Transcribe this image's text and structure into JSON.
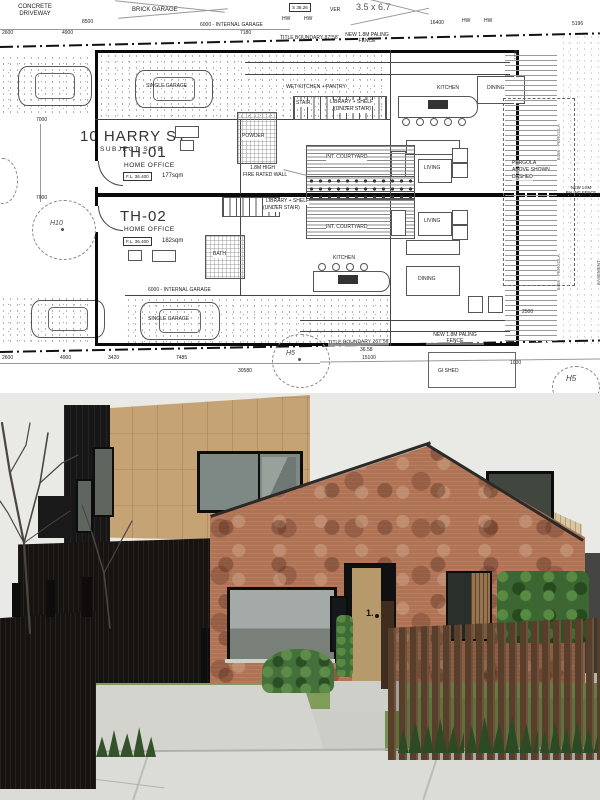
{
  "plan": {
    "site": {
      "title": "10 HARRY ST",
      "subtitle": "SUBJECT SITE",
      "tree_h10": "H10",
      "tree_h5": "H5",
      "gi_shed": "GI SHED",
      "concrete_driveway": "CONCRETE DRIVEWAY",
      "brick_garage": "BRICK GARAGE",
      "neighbor_garage_size": "3.5 x 6.7",
      "spot_level": "S 38.26",
      "veranda": "VER",
      "hw_marker": "HW"
    },
    "boundaries": {
      "top_label": "TITLE BOUNDARY  87°58'",
      "bottom_label": "TITLE BOUNDARY  267°58'",
      "bottom_length": "36.58",
      "fence_note": "NEW 1.8M PALING FENCE",
      "easement": "EASEMENT",
      "pergola_line1": "PERGOLA",
      "pergola_line2": "ABOVE SHOWN",
      "pergola_line3": "DASHED",
      "pergola_dim": "6455 - PERGOLA"
    },
    "units": {
      "th01": {
        "id": "TH-01",
        "use": "HOME OFFICE",
        "level": "F.L. 36.400",
        "area": "177sqm"
      },
      "th02": {
        "id": "TH-02",
        "use": "HOME OFFICE",
        "level": "F.L. 36.400",
        "area": "182sqm"
      }
    },
    "rooms": {
      "single_garage": "SINGLE GARAGE",
      "internal_garage": "6000 - INTERNAL GARAGE",
      "wet_kitchen": "WET KITCHEN + PANTRY",
      "stair": "STAIR",
      "library_line1": "LIBRARY + SHELF",
      "library_line2": "(UNDER STAIR)",
      "kitchen": "KITCHEN",
      "dining": "DINING",
      "living": "LIVING",
      "courtyard": "INT. COURTYARD",
      "powder": "POWDER",
      "bath": "BATH",
      "firewall_line1": "1.8M HIGH",
      "firewall_line2": "FIRE RATED WALL"
    },
    "dims": {
      "d8500": "8500",
      "d7180": "7180",
      "d16400": "16400",
      "d5196": "5196",
      "d2600": "2600",
      "d4900": "4900",
      "d3420": "3420",
      "d7485": "7485",
      "d30580": "30580",
      "d15100": "15100",
      "d1000": "1000",
      "d2500": "2500",
      "d7000": "7000",
      "d1730": "1730"
    }
  },
  "render": {
    "door_number": "1."
  },
  "colors": {
    "brick": "#b07355",
    "timber_upper": "#c6a374",
    "timber_gable": "#d6c6a2",
    "black_cladding": "#161616",
    "fence_brown": "#5d422e",
    "grass": "#7f9c58",
    "sky": "#e9e9e5"
  }
}
